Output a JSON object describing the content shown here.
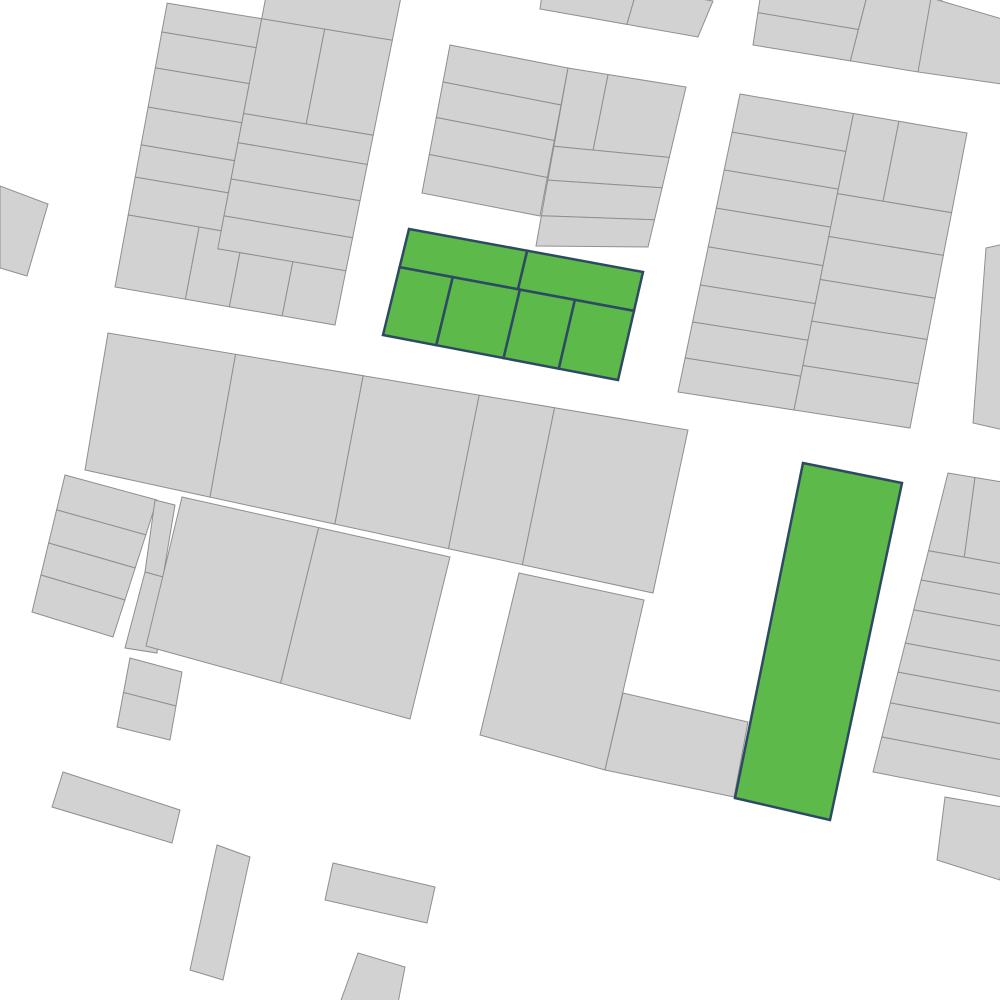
{
  "map": {
    "width": 1000,
    "height": 1000,
    "background": "#ffffff",
    "parcel_style": {
      "fill": "#d2d2d2",
      "stroke": "#8f8f8f",
      "stroke_width": 1
    },
    "selected_style": {
      "fill": "#5cb94a",
      "stroke": "#2e4a63",
      "stroke_width": 2.5
    },
    "selected_feature_count": 2,
    "blocks": [
      {
        "id": "block-a",
        "kind": "grid",
        "selected": false,
        "corners": [
          [
            176,
            -45
          ],
          [
            402,
            -8
          ],
          [
            335,
            325
          ],
          [
            115,
            287
          ]
        ],
        "cells": [
          [
            0.42,
            0,
            1,
            0.145
          ],
          [
            0,
            0.145,
            0.42,
            0.232
          ],
          [
            0,
            0.232,
            0.42,
            0.34
          ],
          [
            0,
            0.34,
            0.42,
            0.458
          ],
          [
            0,
            0.458,
            0.42,
            0.572
          ],
          [
            0,
            0.572,
            0.42,
            0.669
          ],
          [
            0,
            0.669,
            0.42,
            0.783
          ],
          [
            0,
            0.783,
            0.32,
            1
          ],
          [
            0.32,
            0.783,
            0.52,
            1
          ],
          [
            0.52,
            0.837,
            0.76,
            1
          ],
          [
            0.76,
            0.837,
            1,
            1
          ],
          [
            0.42,
            0.145,
            0.7,
            0.43
          ],
          [
            0.7,
            0.145,
            1,
            0.43
          ],
          [
            0.42,
            0.43,
            1,
            0.518
          ],
          [
            0.42,
            0.518,
            1,
            0.627
          ],
          [
            0.42,
            0.627,
            1,
            0.738
          ],
          [
            0.42,
            0.738,
            1,
            0.837
          ]
        ]
      },
      {
        "id": "parcel-a2",
        "kind": "poly",
        "selected": false,
        "points": [
          [
            0,
            186
          ],
          [
            48,
            204
          ],
          [
            27,
            276
          ],
          [
            0,
            268
          ]
        ]
      },
      {
        "id": "block-t",
        "kind": "grid",
        "selected": false,
        "corners": [
          [
            545,
            -28
          ],
          [
            713,
            1
          ],
          [
            698,
            37
          ],
          [
            540,
            9
          ]
        ],
        "cells": [
          [
            0,
            0,
            0.55,
            1
          ],
          [
            0.55,
            0,
            1,
            1
          ]
        ]
      },
      {
        "id": "block-b-left",
        "kind": "grid",
        "selected": false,
        "corners": [
          [
            450,
            45
          ],
          [
            568,
            68
          ],
          [
            540,
            216
          ],
          [
            422,
            193
          ]
        ],
        "cells": [
          [
            0,
            0,
            1,
            0.25
          ],
          [
            0,
            0.25,
            1,
            0.49
          ],
          [
            0,
            0.49,
            1,
            0.74
          ],
          [
            0,
            0.74,
            1,
            1
          ]
        ]
      },
      {
        "id": "block-b-right",
        "kind": "grid",
        "selected": false,
        "corners": [
          [
            568,
            68
          ],
          [
            686,
            87
          ],
          [
            648,
            247
          ],
          [
            536,
            246
          ]
        ],
        "cells": [
          [
            0,
            0,
            0.34,
            0.44
          ],
          [
            0.34,
            0,
            1,
            0.44
          ],
          [
            0,
            0.44,
            1,
            0.63
          ],
          [
            0,
            0.63,
            1,
            0.83
          ],
          [
            0,
            0.83,
            1,
            1
          ]
        ]
      },
      {
        "id": "block-d",
        "kind": "grid",
        "selected": false,
        "corners": [
          [
            766,
            -40
          ],
          [
            945,
            -9
          ],
          [
            918,
            72
          ],
          [
            753,
            45
          ]
        ],
        "cells": [
          [
            0,
            0,
            0.59,
            0.62
          ],
          [
            0,
            0.62,
            0.59,
            1
          ],
          [
            0.59,
            0,
            1,
            1
          ]
        ]
      },
      {
        "id": "parcel-d-corner",
        "kind": "poly",
        "selected": false,
        "points": [
          [
            931,
            -2
          ],
          [
            1002,
            19
          ],
          [
            1002,
            84
          ],
          [
            918,
            72
          ]
        ]
      },
      {
        "id": "block-c",
        "kind": "grid",
        "selected": false,
        "corners": [
          [
            740,
            94
          ],
          [
            967,
            133
          ],
          [
            910,
            428
          ],
          [
            678,
            392
          ]
        ],
        "cells": [
          [
            0,
            0,
            0.5,
            0.128
          ],
          [
            0,
            0.128,
            0.5,
            0.255
          ],
          [
            0,
            0.255,
            0.5,
            0.383
          ],
          [
            0,
            0.383,
            0.5,
            0.513
          ],
          [
            0,
            0.513,
            0.5,
            0.641
          ],
          [
            0,
            0.641,
            0.5,
            0.765
          ],
          [
            0,
            0.765,
            0.5,
            0.886
          ],
          [
            0,
            0.886,
            0.5,
            1
          ],
          [
            0.5,
            0,
            0.7,
            0.27
          ],
          [
            0.7,
            0,
            1,
            0.27
          ],
          [
            0.5,
            0.27,
            1,
            0.415
          ],
          [
            0.5,
            0.415,
            1,
            0.56
          ],
          [
            0.5,
            0.56,
            1,
            0.7
          ],
          [
            0.5,
            0.7,
            1,
            0.85
          ],
          [
            0.5,
            0.85,
            1,
            1
          ]
        ]
      },
      {
        "id": "parcel-c2",
        "kind": "poly",
        "selected": false,
        "points": [
          [
            986,
            248
          ],
          [
            1004,
            244
          ],
          [
            1004,
            430
          ],
          [
            973,
            423
          ]
        ]
      },
      {
        "id": "block-c3",
        "kind": "grid",
        "selected": false,
        "corners": [
          [
            948,
            473
          ],
          [
            1008,
            483
          ],
          [
            1008,
            798
          ],
          [
            873,
            772
          ]
        ],
        "cells": [
          [
            0,
            0,
            0.45,
            0.26
          ],
          [
            0.45,
            0,
            1,
            0.26
          ],
          [
            0,
            0.26,
            1,
            0.358
          ],
          [
            0,
            0.358,
            1,
            0.458
          ],
          [
            0,
            0.458,
            1,
            0.569
          ],
          [
            0,
            0.569,
            1,
            0.666
          ],
          [
            0,
            0.666,
            1,
            0.769
          ],
          [
            0,
            0.769,
            1,
            0.883
          ],
          [
            0,
            0.883,
            1,
            1
          ]
        ]
      },
      {
        "id": "parcel-c4",
        "kind": "poly",
        "selected": false,
        "points": [
          [
            945,
            797
          ],
          [
            1008,
            808
          ],
          [
            1000,
            880
          ],
          [
            937,
            860
          ]
        ]
      },
      {
        "id": "block-e",
        "kind": "grid",
        "selected": false,
        "corners": [
          [
            108,
            333
          ],
          [
            688,
            430
          ],
          [
            653,
            593
          ],
          [
            85,
            470
          ]
        ],
        "cells": [
          [
            0,
            0,
            0.22,
            1
          ],
          [
            0.22,
            0,
            0.44,
            1
          ],
          [
            0.44,
            0,
            0.64,
            1
          ],
          [
            0.64,
            0,
            0.77,
            1
          ],
          [
            0.77,
            0,
            1,
            1
          ]
        ]
      },
      {
        "id": "block-h",
        "kind": "grid",
        "selected": false,
        "corners": [
          [
            65,
            475
          ],
          [
            157,
            500
          ],
          [
            113,
            637
          ],
          [
            32,
            612
          ]
        ],
        "cells": [
          [
            0,
            0,
            1,
            0.255
          ],
          [
            0,
            0.255,
            1,
            0.496
          ],
          [
            0,
            0.496,
            1,
            0.73
          ],
          [
            0,
            0.73,
            1,
            1
          ]
        ]
      },
      {
        "id": "parcel-h2a",
        "kind": "poly",
        "selected": false,
        "points": [
          [
            155,
            500
          ],
          [
            175,
            505
          ],
          [
            163,
            577
          ],
          [
            145,
            572
          ]
        ]
      },
      {
        "id": "parcel-h2b",
        "kind": "poly",
        "selected": false,
        "points": [
          [
            145,
            572
          ],
          [
            163,
            577
          ],
          [
            157,
            653
          ],
          [
            125,
            648
          ]
        ]
      },
      {
        "id": "block-h3",
        "kind": "grid",
        "selected": false,
        "corners": [
          [
            130,
            658
          ],
          [
            182,
            672
          ],
          [
            170,
            740
          ],
          [
            117,
            727
          ]
        ],
        "cells": [
          [
            0,
            0,
            1,
            0.5
          ],
          [
            0,
            0.5,
            1,
            1
          ]
        ]
      },
      {
        "id": "block-i",
        "kind": "grid",
        "selected": false,
        "corners": [
          [
            182,
            497
          ],
          [
            450,
            557
          ],
          [
            410,
            719
          ],
          [
            146,
            646
          ]
        ],
        "cells": [
          [
            0,
            0,
            0.51,
            1
          ],
          [
            0.51,
            0,
            1,
            1
          ]
        ]
      },
      {
        "id": "parcel-f",
        "kind": "poly",
        "selected": false,
        "points": [
          [
            519,
            573
          ],
          [
            644,
            600
          ],
          [
            605,
            770
          ],
          [
            480,
            735
          ]
        ]
      },
      {
        "id": "parcel-f2",
        "kind": "poly",
        "selected": false,
        "points": [
          [
            623,
            693
          ],
          [
            748,
            722
          ],
          [
            734,
            797
          ],
          [
            605,
            770
          ]
        ]
      },
      {
        "id": "parcel-s1",
        "kind": "poly",
        "selected": false,
        "points": [
          [
            63,
            772
          ],
          [
            180,
            810
          ],
          [
            172,
            843
          ],
          [
            52,
            807
          ]
        ]
      },
      {
        "id": "parcel-s2",
        "kind": "poly",
        "selected": false,
        "points": [
          [
            217,
            845
          ],
          [
            250,
            857
          ],
          [
            223,
            980
          ],
          [
            190,
            970
          ]
        ]
      },
      {
        "id": "parcel-s3",
        "kind": "poly",
        "selected": false,
        "points": [
          [
            333,
            863
          ],
          [
            435,
            887
          ],
          [
            427,
            923
          ],
          [
            325,
            900
          ]
        ]
      },
      {
        "id": "parcel-s4",
        "kind": "poly",
        "selected": false,
        "points": [
          [
            358,
            953
          ],
          [
            405,
            967
          ],
          [
            398,
            1003
          ],
          [
            340,
            1003
          ]
        ]
      },
      {
        "id": "block-g1",
        "kind": "grid",
        "selected": true,
        "corners": [
          [
            409,
            229
          ],
          [
            643,
            272
          ],
          [
            618,
            380
          ],
          [
            383,
            335
          ]
        ],
        "cells": [
          [
            0,
            0,
            0.505,
            0.36
          ],
          [
            0.505,
            0,
            1,
            0.36
          ],
          [
            0,
            0.36,
            0.227,
            1
          ],
          [
            0.227,
            0.36,
            0.513,
            1
          ],
          [
            0.513,
            0.36,
            0.748,
            1
          ],
          [
            0.748,
            0.36,
            1,
            1
          ]
        ]
      },
      {
        "id": "parcel-g2",
        "kind": "poly",
        "selected": true,
        "points": [
          [
            803,
            463
          ],
          [
            902,
            483
          ],
          [
            830,
            820
          ],
          [
            735,
            798
          ]
        ]
      }
    ]
  }
}
